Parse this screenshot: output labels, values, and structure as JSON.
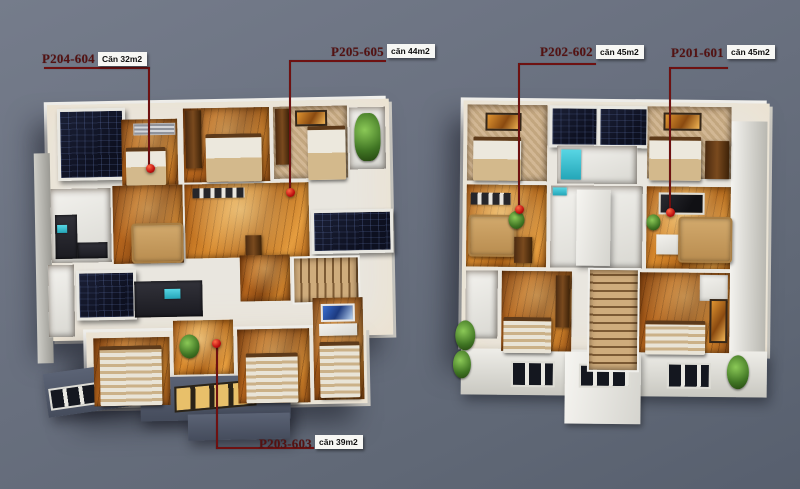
{
  "units": [
    {
      "code": "P204-604",
      "area": "Căn 32m2"
    },
    {
      "code": "P205-605",
      "area": "căn 44m2"
    },
    {
      "code": "P202-602",
      "area": "căn 45m2"
    },
    {
      "code": "P201-601",
      "area": "căn 45m2"
    },
    {
      "code": "P203-603",
      "area": "căn 39m2"
    }
  ],
  "palette": {
    "background": "#666d7c",
    "leader_line": "#6e1111",
    "marker_dot": "#c01010",
    "unit_code_text": "#541212",
    "area_box_bg": "#f7f7f4",
    "area_box_text": "#101010",
    "wall_white": "#e9e6df",
    "wood_floor": "#b5651d",
    "balcony_panel_navy": "#141830",
    "sofa_tan": "#c79f63",
    "stair_wood": "#cfac7c",
    "plant_green": "#3f7423"
  }
}
